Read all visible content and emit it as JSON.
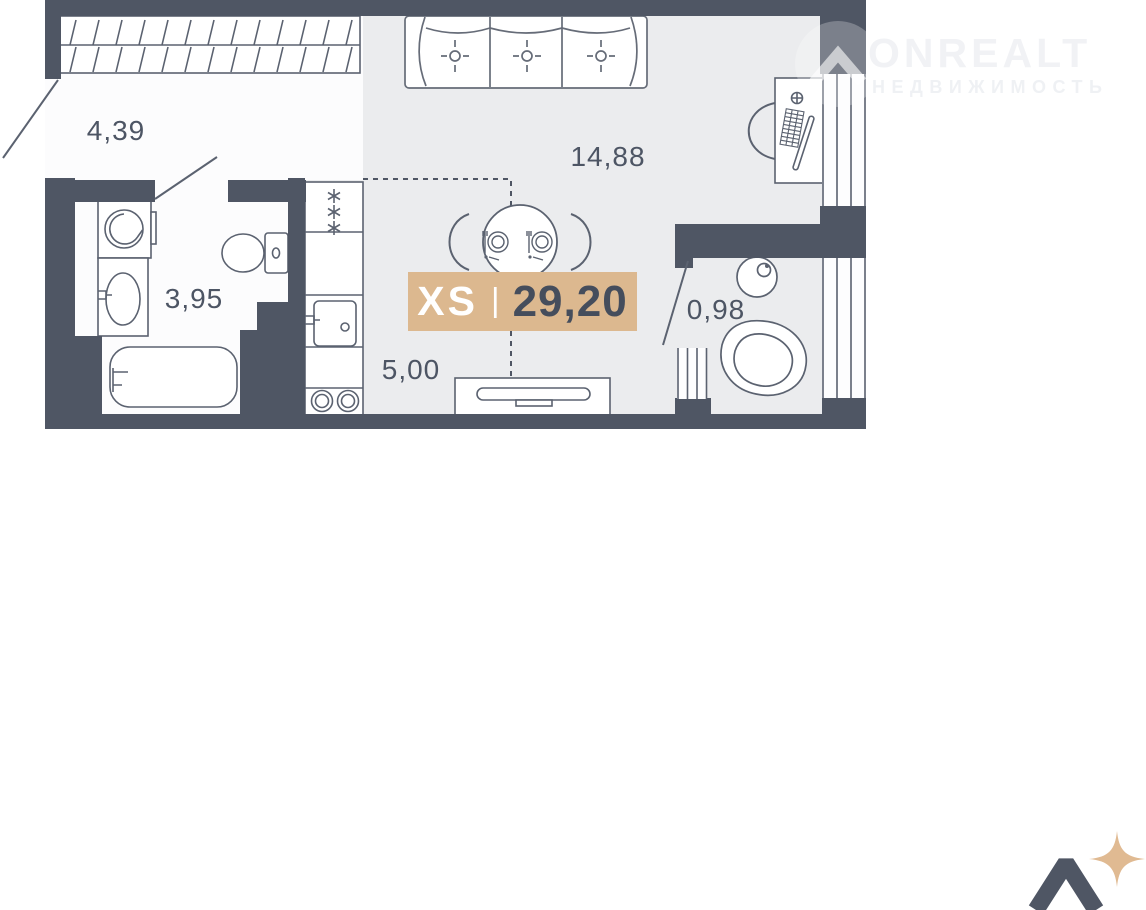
{
  "watermark": {
    "brand": "ONREALT",
    "tagline": "НЕДВИЖИМОСТЬ"
  },
  "badge": {
    "size_class": "XS",
    "divider": "|",
    "area": "29,20"
  },
  "rooms": [
    {
      "id": "hallway",
      "area": "4,39"
    },
    {
      "id": "living-room",
      "area": "14,88"
    },
    {
      "id": "bathroom",
      "area": "3,95"
    },
    {
      "id": "kitchen",
      "area": "5,00"
    },
    {
      "id": "balcony",
      "area": "0,98"
    }
  ],
  "colors": {
    "wall": "#4f5664",
    "floor": "#ebecee",
    "floor_light": "#fcfcfd",
    "outline": "#5b6270",
    "accent": "#dcb88f",
    "badge_number": "#454d5c",
    "label_text": "#4d5564",
    "sparkle": "#e0ba92"
  }
}
